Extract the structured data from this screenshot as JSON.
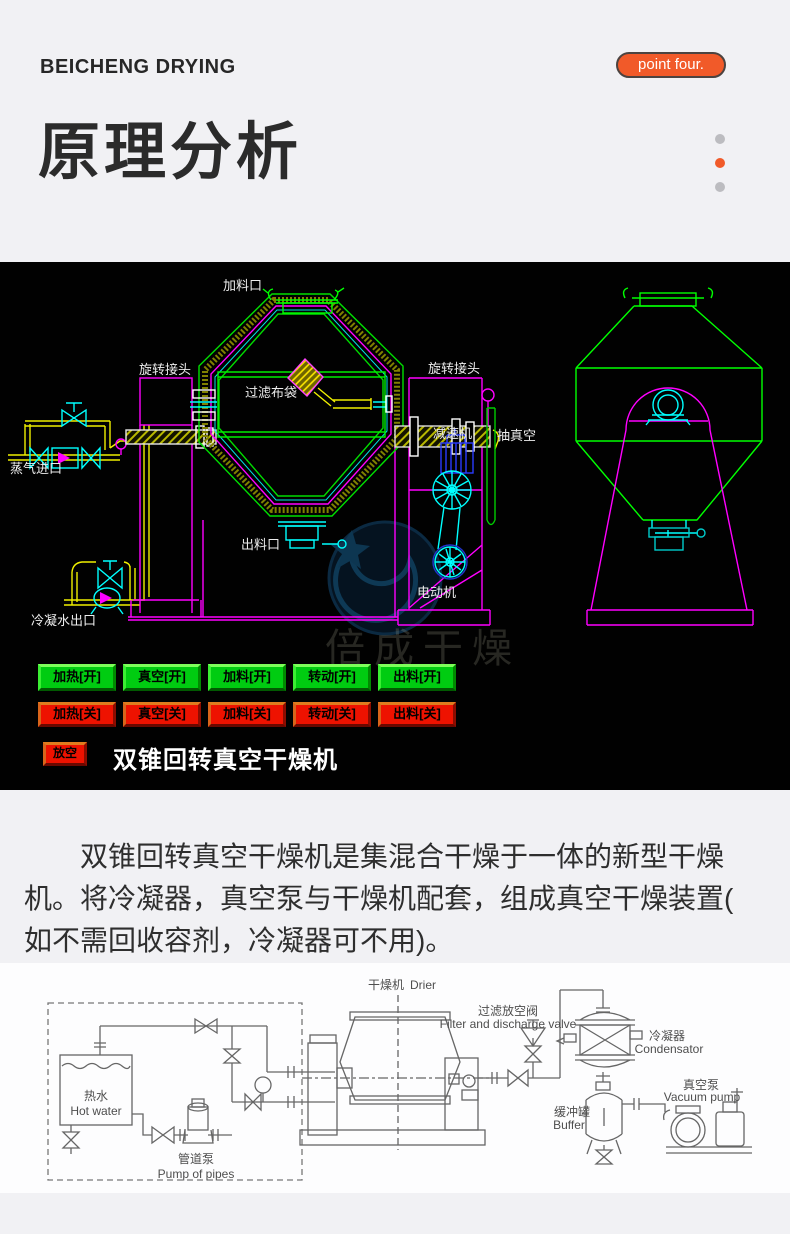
{
  "header": {
    "brand": "BEICHENG DRYING",
    "badge": "point four.",
    "title": "原理分析"
  },
  "colors": {
    "accent": "#f15a29",
    "on_green": "#00cc11",
    "off_red": "#ee1200",
    "cad_green": "#00e000",
    "cad_magenta": "#ff00ff",
    "cad_cyan": "#00ffff",
    "cad_yellow": "#f0f000"
  },
  "cad": {
    "labels": {
      "feed_port": "加料口",
      "rotary_joint_left": "旋转接头",
      "filter_bag": "过滤布袋",
      "steam_inlet": "蒸气进口",
      "rotary_joint_right": "旋转接头",
      "reducer": "减速机",
      "vacuum_suction": "抽真空",
      "discharge_port": "出料口",
      "motor": "电动机",
      "condensate_outlet": "冷凝水出口"
    },
    "buttons_on": [
      "加热[开]",
      "真空[开]",
      "加料[开]",
      "转动[开]",
      "出料[开]"
    ],
    "buttons_off": [
      "加热[关]",
      "真空[关]",
      "加料[关]",
      "转动[关]",
      "出料[关]"
    ],
    "vent_button": "放空",
    "caption": "双锥回转真空干燥机",
    "watermark": "倍成干燥"
  },
  "description": "双锥回转真空干燥机是集混合干燥于一体的新型干燥机。将冷凝器，真空泵与干燥机配套，组成真空干燥装置( 如不需回收容剂，冷凝器可不用)。",
  "flow": {
    "labels": {
      "drier_cn": "干燥机",
      "drier_en": "Drier",
      "filter_cn": "过滤放空阀",
      "filter_en": "Filter and discharge valve",
      "condenser_cn": "冷凝器",
      "condenser_en": "Condensator",
      "buffer_cn": "缓冲罐",
      "buffer_en": "Buffer",
      "vacuum_cn": "真空泵",
      "vacuum_en": "Vacuum pump",
      "hotwater_cn": "热水",
      "hotwater_en": "Hot water",
      "pump_cn": "管道泵",
      "pump_en": "Pump of pipes"
    }
  }
}
